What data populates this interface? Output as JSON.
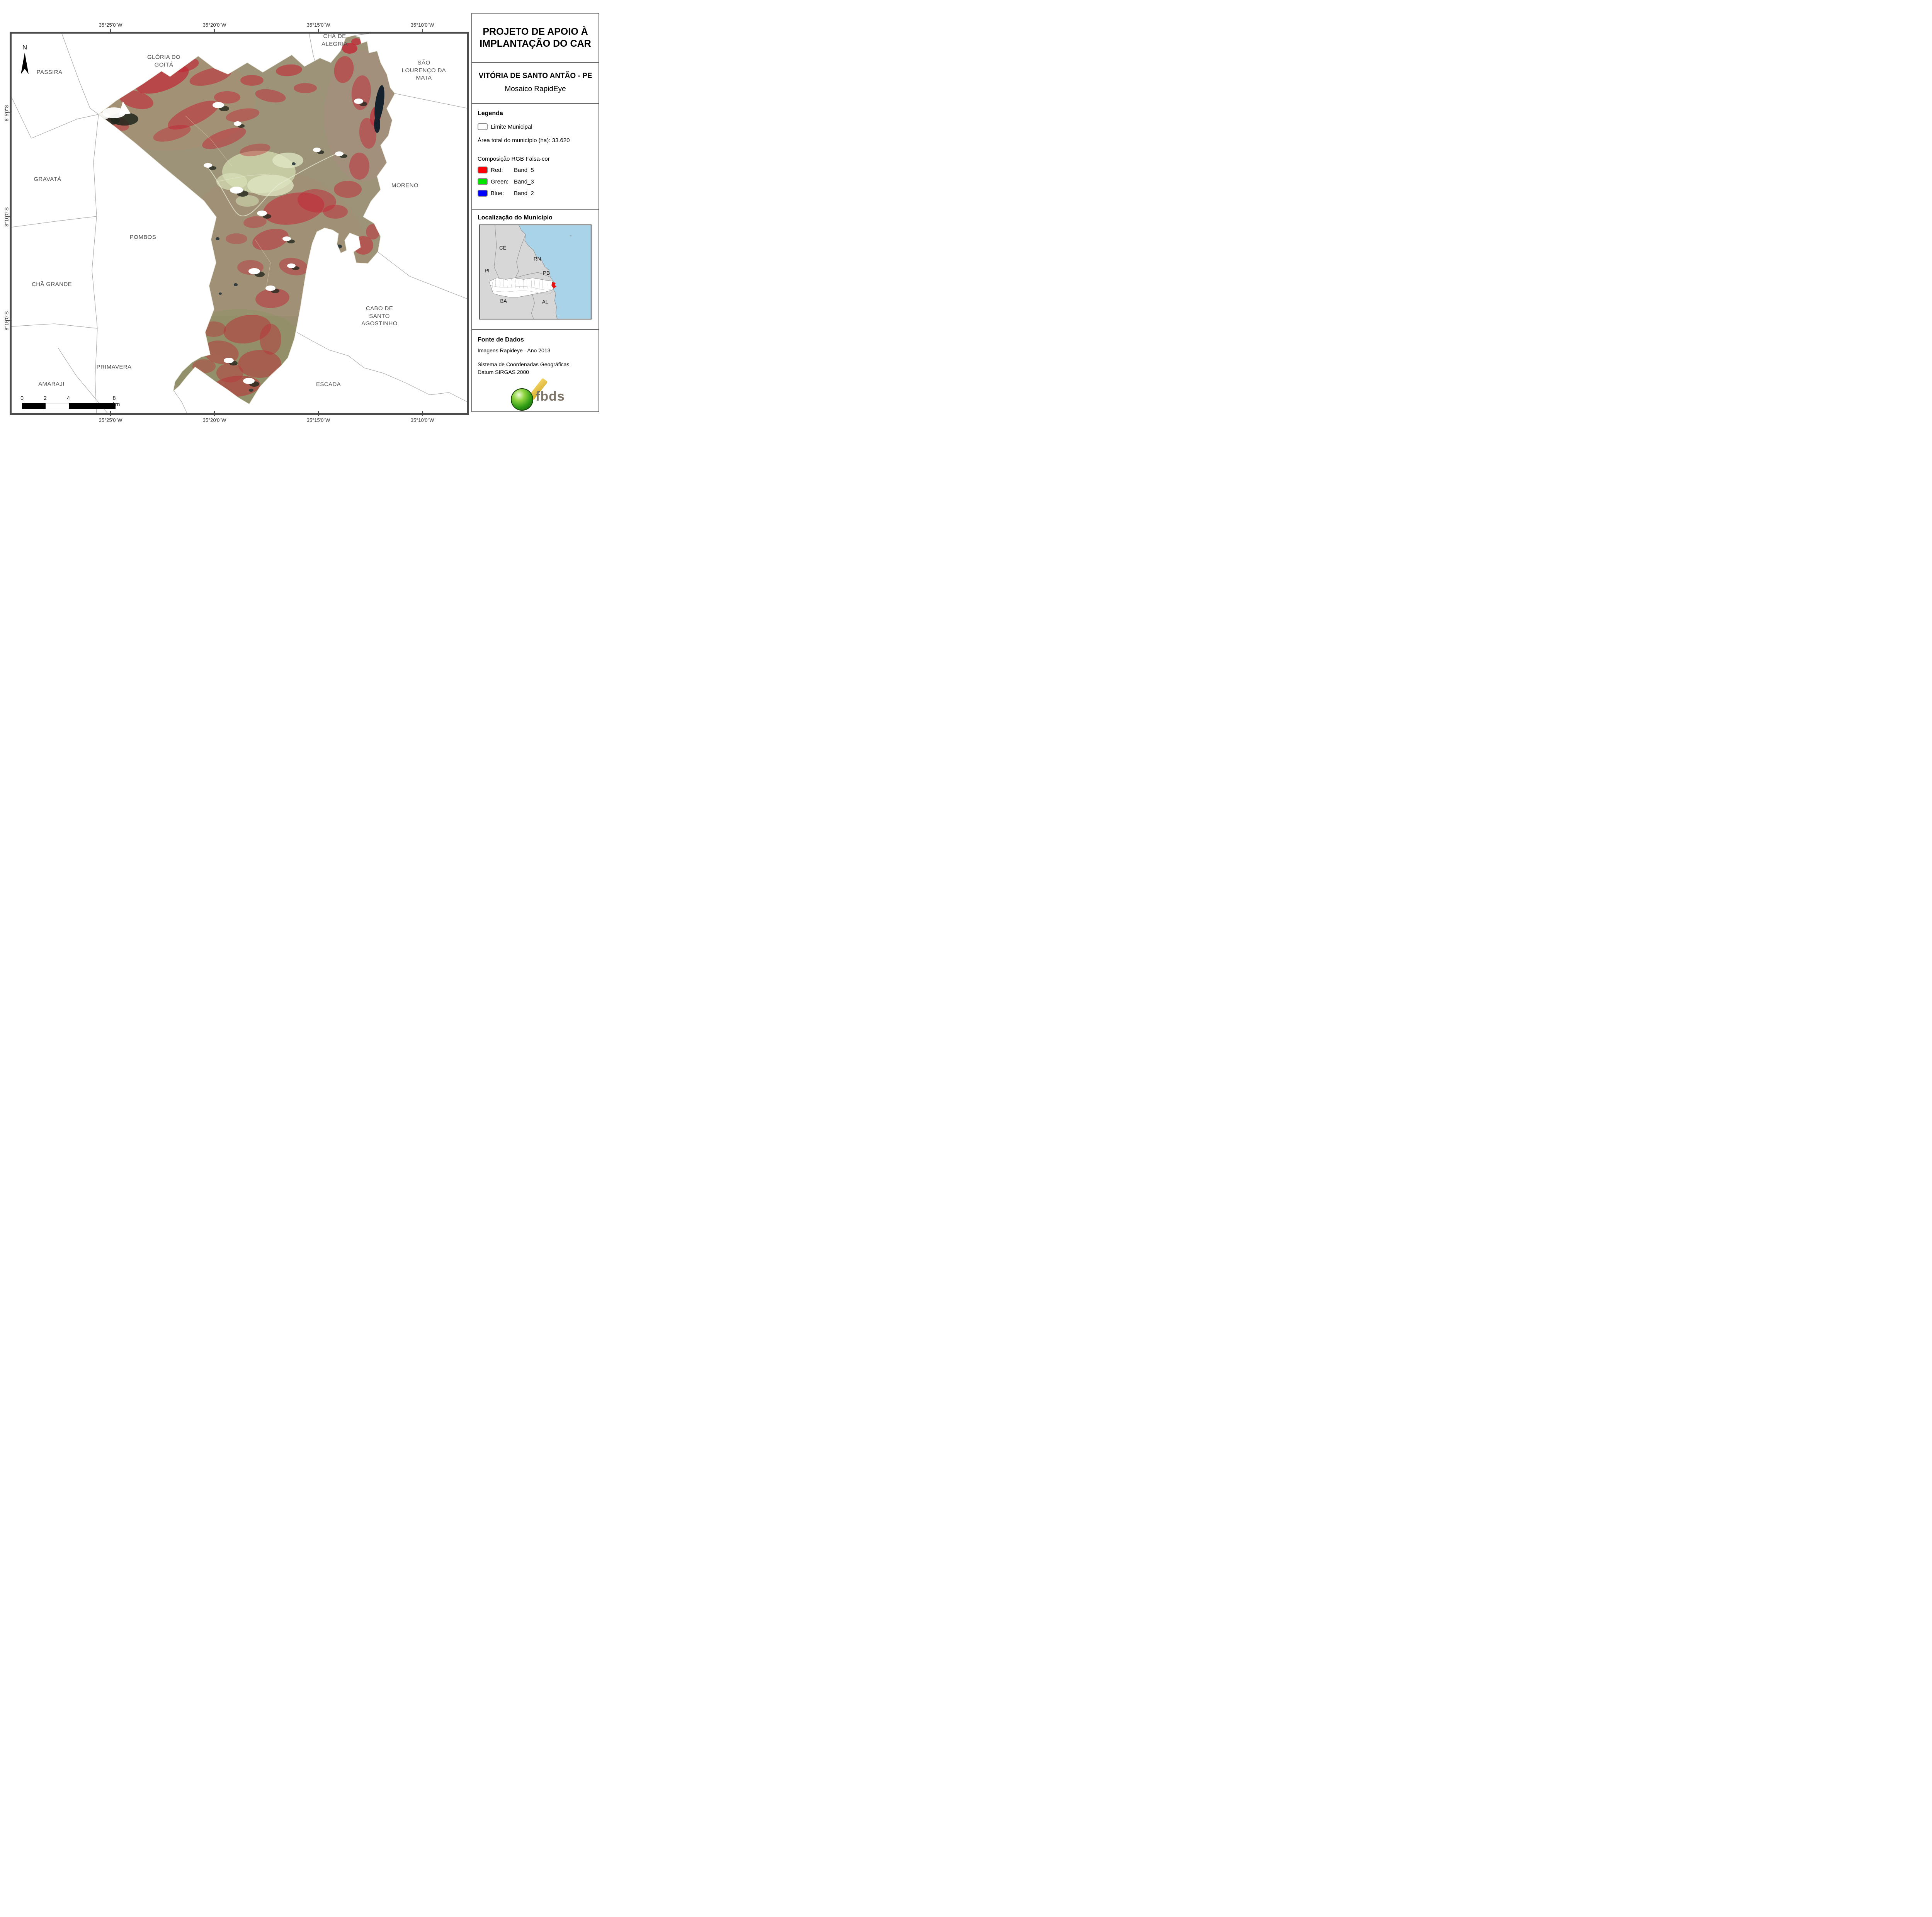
{
  "titleblock": {
    "line1": "PROJETO DE APOIO À",
    "line2": "IMPLANTAÇÃO DO CAR",
    "municipality": "VITÓRIA DE SANTO ANTÃO - PE",
    "product": "Mosaico RapidEye"
  },
  "legend": {
    "heading": "Legenda",
    "limite": "Limite Municipal",
    "area": "Área total do município (ha): 33.620",
    "composition": "Composição RGB Falsa-cor",
    "bands": [
      {
        "channel": "Red:",
        "band": "Band_5",
        "color": "#ff0000"
      },
      {
        "channel": "Green:",
        "band": "Band_3",
        "color": "#00e400"
      },
      {
        "channel": "Blue:",
        "band": "Band_2",
        "color": "#0000ff"
      }
    ]
  },
  "localizacao": {
    "heading": "Localização do Município",
    "states": [
      "CE",
      "RN",
      "PI",
      "PB",
      "BA",
      "AL"
    ],
    "highlight_color": "#e81111",
    "ocean_color": "#a9d3e9"
  },
  "fonte": {
    "heading": "Fonte de Dados",
    "line1": "Imagens Rapideye - Ano 2013",
    "line2": "Sistema de Coordenadas Geográficas",
    "line3": "Datum SIRGAS 2000"
  },
  "logo": {
    "text": "fbds"
  },
  "map": {
    "north_label": "N",
    "coords_top": [
      "35°25'0\"W",
      "35°20'0\"W",
      "35°15'0\"W",
      "35°10'0\"W"
    ],
    "coords_bottom": [
      "35°25'0\"W",
      "35°20'0\"W",
      "35°15'0\"W",
      "35°10'0\"W"
    ],
    "coords_left": [
      "8°5'0\"S",
      "8°10'0\"S",
      "8°15'0\"S"
    ],
    "scalebar": {
      "t0": "0",
      "t2": "2",
      "t4": "4",
      "t8": "8 km"
    },
    "places": [
      {
        "name": "passira",
        "text": "PASSIRA"
      },
      {
        "name": "gloria-do-goita",
        "text": "GLÓRIA DO\nGOITÁ"
      },
      {
        "name": "cha-de-alegria",
        "text": "CHÃ DE\nALEGRIA"
      },
      {
        "name": "sao-lourenco-da-mata",
        "text": "SÃO\nLOURENÇO DA\nMATA"
      },
      {
        "name": "gravata",
        "text": "GRAVATÁ"
      },
      {
        "name": "moreno",
        "text": "MORENO"
      },
      {
        "name": "pombos",
        "text": "POMBOS"
      },
      {
        "name": "cha-grande",
        "text": "CHÃ GRANDE"
      },
      {
        "name": "cabo-de-santo-agostinho",
        "text": "CABO DE\nSANTO\nAGOSTINHO"
      },
      {
        "name": "primavera",
        "text": "PRIMAVERA"
      },
      {
        "name": "amaraji",
        "text": "AMARAJI"
      },
      {
        "name": "escada",
        "text": "ESCADA"
      }
    ]
  }
}
